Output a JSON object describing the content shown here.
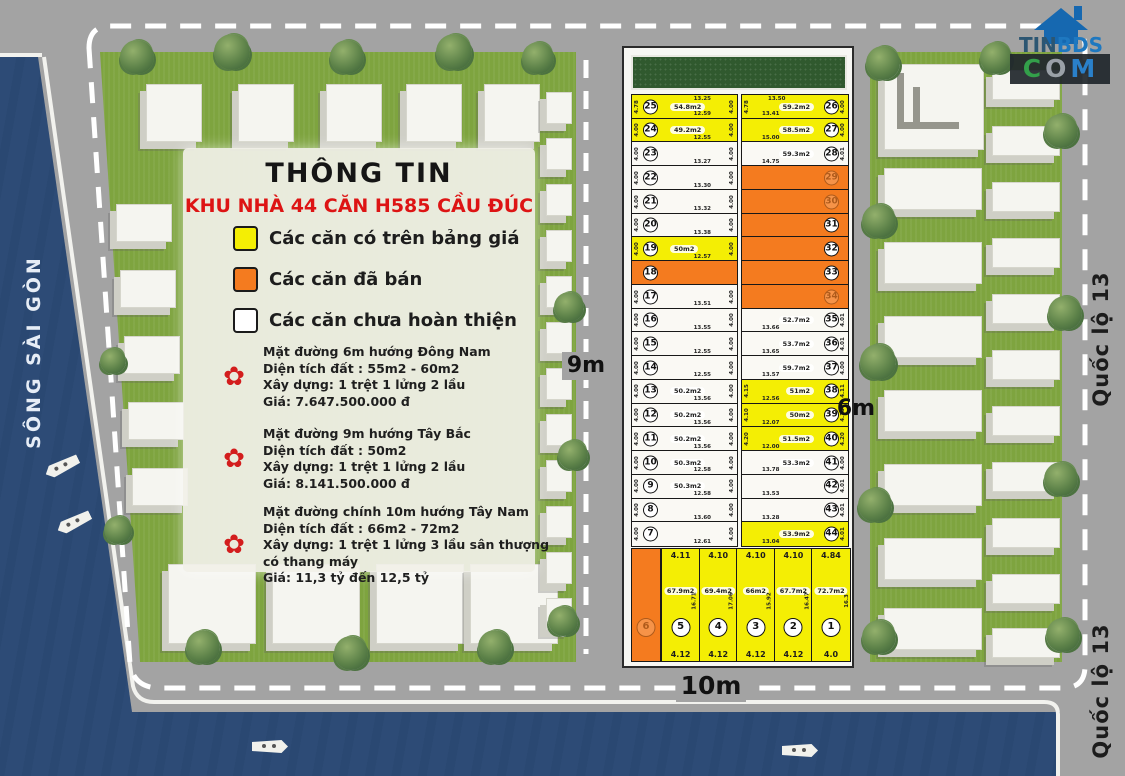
{
  "info": {
    "title": "THÔNG TIN",
    "subtitle": "KHU NHÀ 44 CĂN H585 CẦU ĐÚC",
    "legend": [
      {
        "color": "#f4ee04",
        "label": "Các căn có trên bảng giá"
      },
      {
        "color": "#f47b1f",
        "label": "Các căn đã bán"
      },
      {
        "color": "#ffffff",
        "label": "Các căn chưa hoàn thiện"
      }
    ],
    "sections": [
      {
        "lines": [
          "Mặt đường 6m hướng Đông Nam",
          "Diện tích đất : 55m2 - 60m2",
          "Xây dựng: 1 trệt 1 lửng 2 lầu",
          "Giá: 7.647.500.000 đ"
        ]
      },
      {
        "lines": [
          "Mặt đường 9m hướng Tây Bắc",
          "Diện tích đất : 50m2",
          "Xây dựng: 1 trệt 1 lửng 2 lầu",
          "Giá: 8.141.500.000 đ"
        ]
      },
      {
        "lines": [
          "Mặt đường chính 10m hướng Tây Nam",
          "Diện tích đất : 66m2 - 72m2",
          "Xây dựng: 1 trệt 1 lửng 3 lầu sân thượng",
          "có thang máy",
          "Giá: 11,3 tỷ đến 12,5 tỷ"
        ]
      }
    ]
  },
  "river": {
    "label": "SÔNG SÀI GÒN"
  },
  "roads": {
    "label_9m": "9m",
    "label_6m": "6m",
    "label_10m": "10m",
    "highway_label_1": "Quốc lộ 13",
    "highway_label_2": "Quốc lộ 13"
  },
  "logo": {
    "part1": "TIN",
    "part2": "BDS",
    "part3_c": "C",
    "part3_o": "O",
    "part3_m": "M"
  },
  "colors": {
    "available": "#f4ee04",
    "sold": "#f47b1f",
    "unfinished": "#faf9f4",
    "river": "#2d4b76",
    "road": "#a3a3a3",
    "grass": "#7ea43f"
  },
  "grid": {
    "left_column": [
      {
        "n": "25",
        "status": "available",
        "area": "54.8m2",
        "top": "13.25",
        "bottom": "12.59",
        "left": "4.78",
        "right": "4.00",
        "faint": false
      },
      {
        "n": "24",
        "status": "available",
        "area": "49.2m2",
        "top": "",
        "bottom": "12.55",
        "left": "4.00",
        "right": "4.00",
        "faint": false
      },
      {
        "n": "23",
        "status": "unfinished",
        "area": "",
        "top": "",
        "bottom": "13.27",
        "left": "4.00",
        "right": "4.00",
        "faint": false
      },
      {
        "n": "22",
        "status": "unfinished",
        "area": "",
        "top": "",
        "bottom": "13.30",
        "left": "4.00",
        "right": "4.00",
        "faint": false
      },
      {
        "n": "21",
        "status": "unfinished",
        "area": "",
        "top": "",
        "bottom": "13.32",
        "left": "4.00",
        "right": "4.00",
        "faint": false
      },
      {
        "n": "20",
        "status": "unfinished",
        "area": "",
        "top": "",
        "bottom": "13.38",
        "left": "4.00",
        "right": "4.00",
        "faint": false
      },
      {
        "n": "19",
        "status": "available",
        "area": "50m2",
        "top": "",
        "bottom": "12.57",
        "left": "4.00",
        "right": "4.00",
        "faint": false
      },
      {
        "n": "18",
        "status": "sold",
        "area": "",
        "top": "",
        "bottom": "",
        "left": "",
        "right": "",
        "faint": false
      },
      {
        "n": "17",
        "status": "unfinished",
        "area": "",
        "top": "",
        "bottom": "13.51",
        "left": "4.00",
        "right": "4.00",
        "faint": false
      },
      {
        "n": "16",
        "status": "unfinished",
        "area": "",
        "top": "",
        "bottom": "13.55",
        "left": "4.00",
        "right": "4.00",
        "faint": false
      },
      {
        "n": "15",
        "status": "unfinished",
        "area": "",
        "top": "",
        "bottom": "12.55",
        "left": "4.00",
        "right": "4.00",
        "faint": false
      },
      {
        "n": "14",
        "status": "unfinished",
        "area": "",
        "top": "",
        "bottom": "12.55",
        "left": "4.00",
        "right": "4.00",
        "faint": false
      },
      {
        "n": "13",
        "status": "unfinished",
        "area": "50.2m2",
        "top": "",
        "bottom": "13.56",
        "left": "4.00",
        "right": "4.00",
        "faint": false
      },
      {
        "n": "12",
        "status": "unfinished",
        "area": "50.2m2",
        "top": "",
        "bottom": "13.56",
        "left": "4.00",
        "right": "4.00",
        "faint": false
      },
      {
        "n": "11",
        "status": "unfinished",
        "area": "50.2m2",
        "top": "",
        "bottom": "13.56",
        "left": "4.00",
        "right": "4.00",
        "faint": false
      },
      {
        "n": "10",
        "status": "unfinished",
        "area": "50.3m2",
        "top": "",
        "bottom": "12.58",
        "left": "4.00",
        "right": "4.00",
        "faint": false
      },
      {
        "n": "9",
        "status": "unfinished",
        "area": "50.3m2",
        "top": "",
        "bottom": "12.58",
        "left": "4.00",
        "right": "4.00",
        "faint": false
      },
      {
        "n": "8",
        "status": "unfinished",
        "area": "",
        "top": "",
        "bottom": "13.60",
        "left": "4.00",
        "right": "4.00",
        "faint": false
      },
      {
        "n": "7",
        "status": "unfinished",
        "area": "",
        "top": "",
        "bottom": "12.61",
        "left": "4.00",
        "right": "4.00",
        "faint": false
      }
    ],
    "right_column": [
      {
        "n": "26",
        "status": "available",
        "area": "59.2m2",
        "top": "13.50",
        "bottom": "13.41",
        "left": "4.78",
        "right": "4.00",
        "faint": false
      },
      {
        "n": "27",
        "status": "available",
        "area": "58.5m2",
        "top": "",
        "bottom": "15.00",
        "left": "",
        "right": "4.00",
        "faint": false
      },
      {
        "n": "28",
        "status": "unfinished",
        "area": "59.3m2",
        "top": "",
        "bottom": "14.75",
        "left": "",
        "right": "4.01",
        "faint": false
      },
      {
        "n": "29",
        "status": "sold",
        "area": "",
        "top": "",
        "bottom": "",
        "left": "",
        "right": "",
        "faint": true
      },
      {
        "n": "30",
        "status": "sold",
        "area": "",
        "top": "",
        "bottom": "",
        "left": "",
        "right": "",
        "faint": true
      },
      {
        "n": "31",
        "status": "sold",
        "area": "",
        "top": "",
        "bottom": "",
        "left": "",
        "right": "",
        "faint": false
      },
      {
        "n": "32",
        "status": "sold",
        "area": "",
        "top": "",
        "bottom": "",
        "left": "",
        "right": "",
        "faint": false
      },
      {
        "n": "33",
        "status": "sold",
        "area": "",
        "top": "",
        "bottom": "",
        "left": "",
        "right": "",
        "faint": false
      },
      {
        "n": "34",
        "status": "sold",
        "area": "",
        "top": "",
        "bottom": "",
        "left": "",
        "right": "",
        "faint": true
      },
      {
        "n": "35",
        "status": "unfinished",
        "area": "52.7m2",
        "top": "",
        "bottom": "13.66",
        "left": "",
        "right": "4.01",
        "faint": false
      },
      {
        "n": "36",
        "status": "unfinished",
        "area": "53.7m2",
        "top": "",
        "bottom": "13.65",
        "left": "",
        "right": "4.01",
        "faint": false
      },
      {
        "n": "37",
        "status": "unfinished",
        "area": "59.7m2",
        "top": "",
        "bottom": "13.57",
        "left": "",
        "right": "4.00",
        "faint": false
      },
      {
        "n": "38",
        "status": "available",
        "area": "51m2",
        "top": "",
        "bottom": "12.56",
        "left": "4.15",
        "right": "4.11",
        "faint": false
      },
      {
        "n": "39",
        "status": "available",
        "area": "50m2",
        "top": "",
        "bottom": "12.07",
        "left": "4.10",
        "right": "4.13",
        "faint": false
      },
      {
        "n": "40",
        "status": "available",
        "area": "51.5m2",
        "top": "",
        "bottom": "12.00",
        "left": "4.20",
        "right": "4.20",
        "faint": false
      },
      {
        "n": "41",
        "status": "unfinished",
        "area": "53.3m2",
        "top": "",
        "bottom": "13.78",
        "left": "",
        "right": "4.00",
        "faint": false
      },
      {
        "n": "42",
        "status": "unfinished",
        "area": "",
        "top": "",
        "bottom": "13.53",
        "left": "",
        "right": "4.01",
        "faint": false
      },
      {
        "n": "43",
        "status": "unfinished",
        "area": "",
        "top": "",
        "bottom": "13.28",
        "left": "",
        "right": "4.01",
        "faint": false
      },
      {
        "n": "44",
        "status": "available",
        "area": "53.9m2",
        "top": "",
        "bottom": "13.04",
        "left": "",
        "right": "4.01",
        "faint": false
      }
    ],
    "bottom_row": [
      {
        "n": "6",
        "status": "sold",
        "area": "",
        "top": "",
        "bottom": "",
        "side": "",
        "faint": true
      },
      {
        "n": "5",
        "status": "available",
        "area": "67.9m2",
        "top": "4.11",
        "bottom": "4.12",
        "side": "16.71",
        "faint": false
      },
      {
        "n": "4",
        "status": "available",
        "area": "69.4m2",
        "top": "4.10",
        "bottom": "4.12",
        "side": "17.06",
        "faint": false
      },
      {
        "n": "3",
        "status": "available",
        "area": "66m2",
        "top": "4.10",
        "bottom": "4.12",
        "side": "15.92",
        "faint": false
      },
      {
        "n": "2",
        "status": "available",
        "area": "67.7m2",
        "top": "4.10",
        "bottom": "4.12",
        "side": "16.47",
        "faint": false
      },
      {
        "n": "1",
        "status": "available",
        "area": "72.7m2",
        "top": "4.84",
        "bottom": "4.0",
        "side": "16.3",
        "faint": false
      }
    ]
  }
}
